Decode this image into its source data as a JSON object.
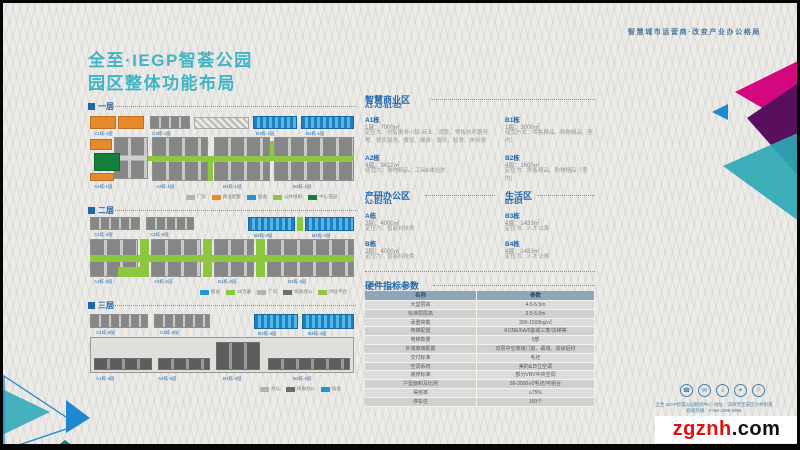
{
  "meta": {
    "tagline": "智慧城市运营商·改变产业办公格局"
  },
  "title": {
    "line1": "全至·IEGP智荟公园",
    "line2": "园区整体功能布局"
  },
  "colors": {
    "accent_teal": "#3fb4c4",
    "header_blue": "#1f66a8",
    "orange": "#e8892b",
    "dorm_blue": "#2196d4",
    "green": "#8dc63f",
    "dark_green": "#15803d",
    "magenta": "#d4087e",
    "purple": "#570f5e",
    "corner_teal": "#2fa8b6",
    "corner_blue": "#1e88d2",
    "watermark_red": "#e01010"
  },
  "floor_plans": [
    {
      "label": "一层",
      "top_labels": [
        "C1栋-1层",
        "C2栋-1层",
        "B3栋-1层",
        "B4栋-1层"
      ],
      "bottom_labels": [
        "A1栋-1层",
        "A2栋-1层",
        "B1栋-1层",
        "B2栋-1层"
      ],
      "legend": [
        {
          "label": "厂房"
        },
        {
          "label": "商业配套"
        },
        {
          "label": "宿舍"
        },
        {
          "label": "公共绿廊"
        },
        {
          "label": "中心花园"
        }
      ]
    },
    {
      "label": "二层",
      "top_labels": [
        "C1栋-2层",
        "C2栋-2层",
        "B3栋-2层",
        "B4栋-2层"
      ],
      "bottom_labels": [
        "A1栋-2层",
        "A2栋-2层",
        "B1栋-2层",
        "B2栋-2层"
      ],
      "legend": [
        {
          "label": "宿舍"
        },
        {
          "label": "2F连廊"
        },
        {
          "label": "厂房"
        },
        {
          "label": "研发办公"
        },
        {
          "label": "绿化平台"
        }
      ]
    },
    {
      "label": "三层",
      "top_labels": [
        "C1栋-3层",
        "C2栋-3层",
        "B3栋-3层",
        "B4栋-3层"
      ],
      "bottom_labels": [
        "A1栋-3层",
        "A2栋-3层",
        "B1栋-3层",
        "B2栋-3层"
      ],
      "legend": [
        {
          "label": "办公"
        },
        {
          "label": "研发办公"
        },
        {
          "label": "宿舍"
        }
      ]
    }
  ],
  "sections": {
    "business": {
      "title": "智慧商业区",
      "code": "A1-A2-B1-B2",
      "a1": {
        "name": "A1栋",
        "floor": "1层：7000㎡",
        "desc": "定位为：创智服务小镇·商业、观景、零售技术服务等、便民服务、餐饮、健身、娱乐、轻食、休闲类"
      },
      "a2": {
        "name": "A2栋",
        "floor": "4层：3422㎡",
        "desc": "经营为：购物精品、工具&体验类"
      },
      "b1": {
        "name": "B1栋",
        "floor": "1层：3000㎡",
        "desc": "经营方式：零售精品、购物精品（室内）"
      },
      "b2": {
        "name": "B2栋",
        "floor": "4层：1600㎡",
        "desc": "定位为：零售精品、购物精品（室内）"
      }
    },
    "office": {
      "title": "产研办公区",
      "code": "A2-B2-B1",
      "a": {
        "name": "A栋",
        "floor": "2层：4000㎡",
        "desc": "定位为：智能科技类"
      },
      "b": {
        "name": "B栋",
        "floor": "2层：4000㎡",
        "desc": "定位为：智能科技类"
      }
    },
    "living": {
      "title": "生活区",
      "code": "B3-B4",
      "b3": {
        "name": "B3栋",
        "floor": "4层：1433㎡",
        "desc": "定位为：人才公寓"
      },
      "b4": {
        "name": "B4栋",
        "floor": "4层：1433㎡",
        "desc": "定位为：人才公寓"
      }
    }
  },
  "spec_table": {
    "title": "硬件指标参数",
    "headers": [
      "名称",
      "参数"
    ],
    "rows": [
      [
        "大堂层高",
        "4.5-5.5m"
      ],
      [
        "标准层层高",
        "3.5-5.5m"
      ],
      [
        "承重荷载",
        "200-1500kg/㎡"
      ],
      [
        "电梯配置",
        "KONE/6A/5客或三菱/货梯等"
      ],
      [
        "电梯数量",
        "5部"
      ],
      [
        "外墙玻璃配置",
        "双层中空玻璃门窗、幕墙、高级铝材"
      ],
      [
        "交付标准",
        "毛坯"
      ],
      [
        "空调系统",
        "美的&日立空调"
      ],
      [
        "装修标准",
        "部分VRV中央空调"
      ],
      [
        "户型面积及比例",
        "66-3000㎡/毛坯/可组合"
      ],
      [
        "得房率",
        "≥75%"
      ],
      [
        "停车位",
        "100个"
      ]
    ]
  },
  "footer": {
    "icon_glyphs": [
      "☎",
      "✉",
      "⌂",
      "✦",
      "⚐"
    ],
    "line1": "全至·IEGP智荟公园招商中心 地址：深圳市宝安区沙井街道",
    "line2": "招商热线：0755-2988 8888"
  },
  "watermark": {
    "red": "zgznh",
    "black": ".com"
  }
}
